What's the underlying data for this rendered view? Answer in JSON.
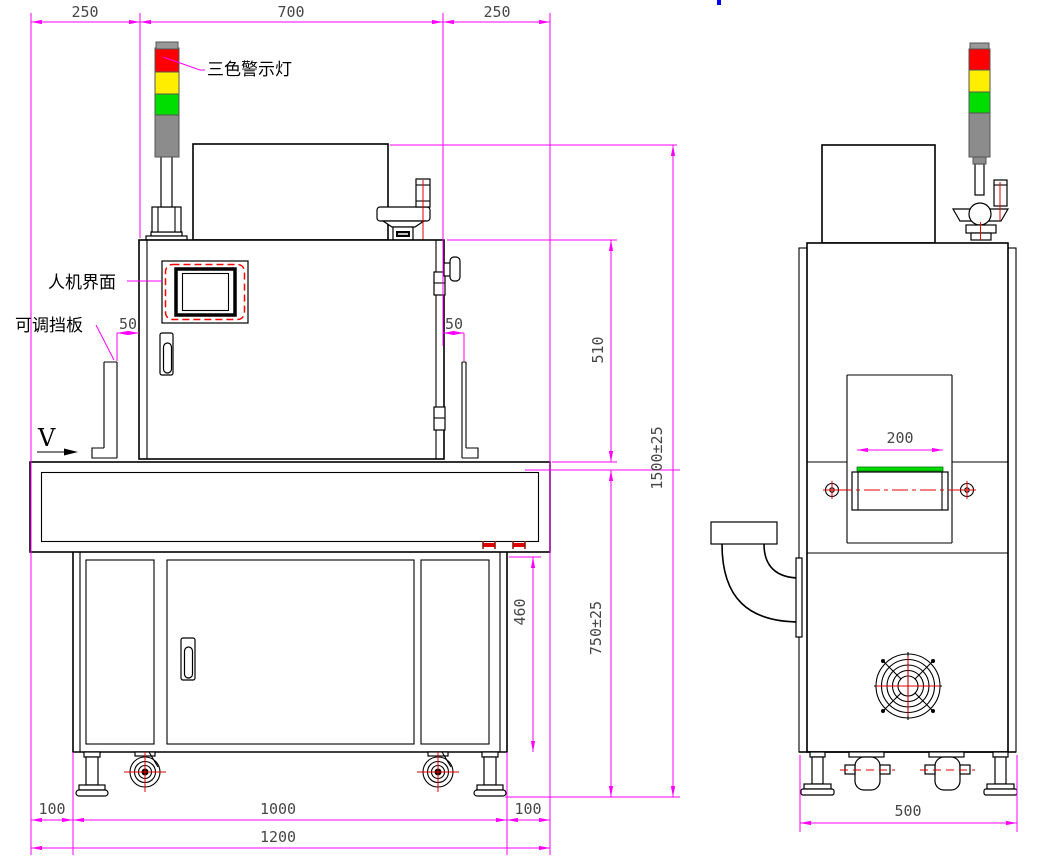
{
  "drawing": {
    "type": "machine outline drawing, front and side orthographic views"
  },
  "labels": {
    "tower_light": "三色警示灯",
    "hmi": "人机界面",
    "adjustable_baffle": "可调挡板",
    "view_direction": "V"
  },
  "dimensions": {
    "front_top_left": "250",
    "front_top_width": "700",
    "front_top_right": "250",
    "left_gap": "50",
    "right_gap": "50",
    "upper_height": "510",
    "total_height": "1500±25",
    "table_height": "750±25",
    "cabinet_inner_height": "460",
    "bottom_left_offset": "100",
    "leg_span": "1000",
    "bottom_right_offset": "100",
    "overall_width": "1200",
    "belt_width": "200",
    "side_depth": "500"
  },
  "colors": {
    "dimension_magenta": "#ff00ff",
    "outline_black": "#000000",
    "detail_red": "#e00000",
    "light_red": "#ff0000",
    "light_yellow": "#ffee00",
    "light_green": "#00dd00",
    "light_gray": "#8c8c8c",
    "light_cap_gray": "#999999",
    "belt_green": "#00dc00",
    "accent_blue": "#0000ee"
  }
}
